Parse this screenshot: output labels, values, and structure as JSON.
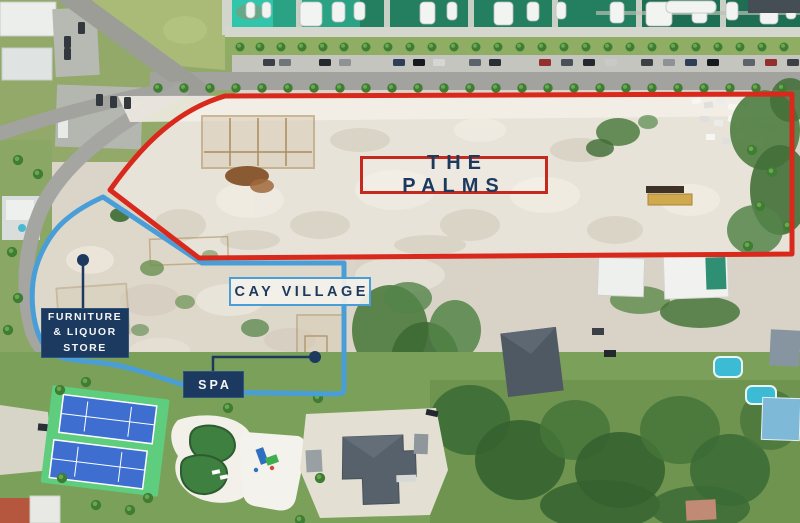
{
  "map": {
    "kind": "aerial-development-site-plan",
    "width": 800,
    "height": 523
  },
  "labels": {
    "the_palms": "THE PALMS",
    "cay_village": "CAY VILLAGE",
    "furniture_line1": "FURNITURE",
    "furniture_line2": "& LIQUOR",
    "furniture_line3": "STORE",
    "spa": "SPA"
  },
  "regions": [
    {
      "name": "The Palms",
      "label": "THE PALMS",
      "boundary_color": "#d8291c",
      "label_style": "red outlined box on sand"
    },
    {
      "name": "Cay Village",
      "label": "CAY VILLAGE",
      "boundary_color": "#4a9ed8",
      "label_style": "light box with blue outline"
    },
    {
      "name": "Furniture & Liquor Store",
      "label": "FURNITURE & LIQUOR STORE",
      "marker_color": "#1d3a5e",
      "label_style": "navy box with leader line and dot"
    },
    {
      "name": "Spa",
      "label": "SPA",
      "marker_color": "#1d3a5e",
      "label_style": "navy box with leader line and dot"
    }
  ],
  "colors": {
    "red_boundary": "#d8291c",
    "blue_boundary": "#4a9ed8",
    "navy": "#1d3a5e",
    "light_label_bg": "#f2f0ea",
    "sand_lot": "#e8e3d8",
    "marina_water": "#237f60",
    "tennis_court": "#3e6ed0",
    "tennis_surround": "#5ecd7d",
    "pool_water": "#3bbcd4"
  },
  "scene": {
    "top": "marina with docked boats, palm-lined parking and road",
    "left": "residential streets and parking lots",
    "center": "cleared sand development parcels with foundation excavations",
    "bottom": "tennis courts, pool lagoon, playground, homes with pools"
  }
}
